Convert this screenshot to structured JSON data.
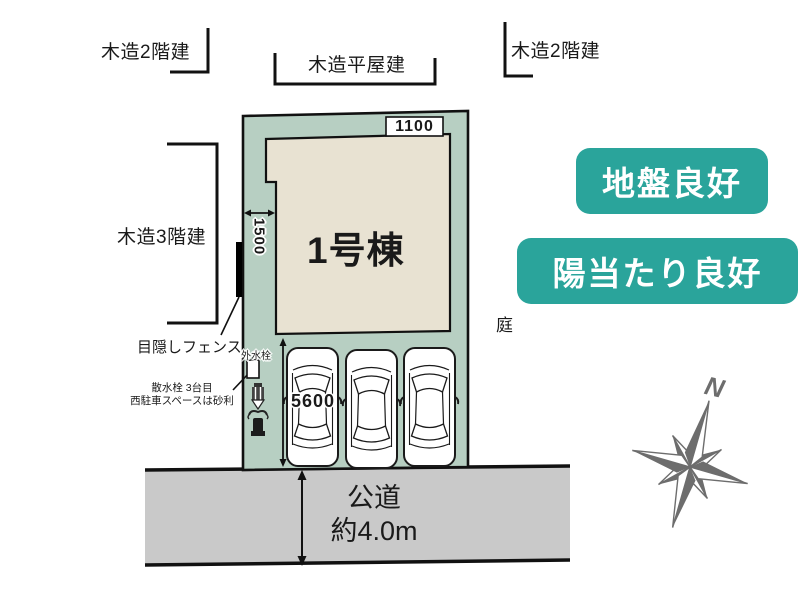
{
  "labels": {
    "top_left_building": "木造2階建",
    "top_center_building": "木造平屋建",
    "top_right_building": "木造2階建",
    "left_building": "木造3階建",
    "fence": "目隠しフェンス",
    "outdoor_tap": "外水栓",
    "note_line1": "散水栓 3台目",
    "note_line2": "西駐車スペースは砂利",
    "garden": "庭",
    "building_name": "1号棟"
  },
  "dimensions": {
    "top_setback": "1100",
    "side_setback": "1500",
    "parking_depth": "5600"
  },
  "road": {
    "name": "公道",
    "width": "約4.0m"
  },
  "compass": {
    "north": "N"
  },
  "badges": [
    {
      "label": "地盤良好"
    },
    {
      "label": "陽当たり良好"
    }
  ],
  "colors": {
    "plot_green": "#b7cfc2",
    "building_beige": "#e8e2d2",
    "road_gray": "#c9c9c9",
    "badge_teal": "#2aa49b",
    "compass_gray": "#6d6d6d"
  }
}
